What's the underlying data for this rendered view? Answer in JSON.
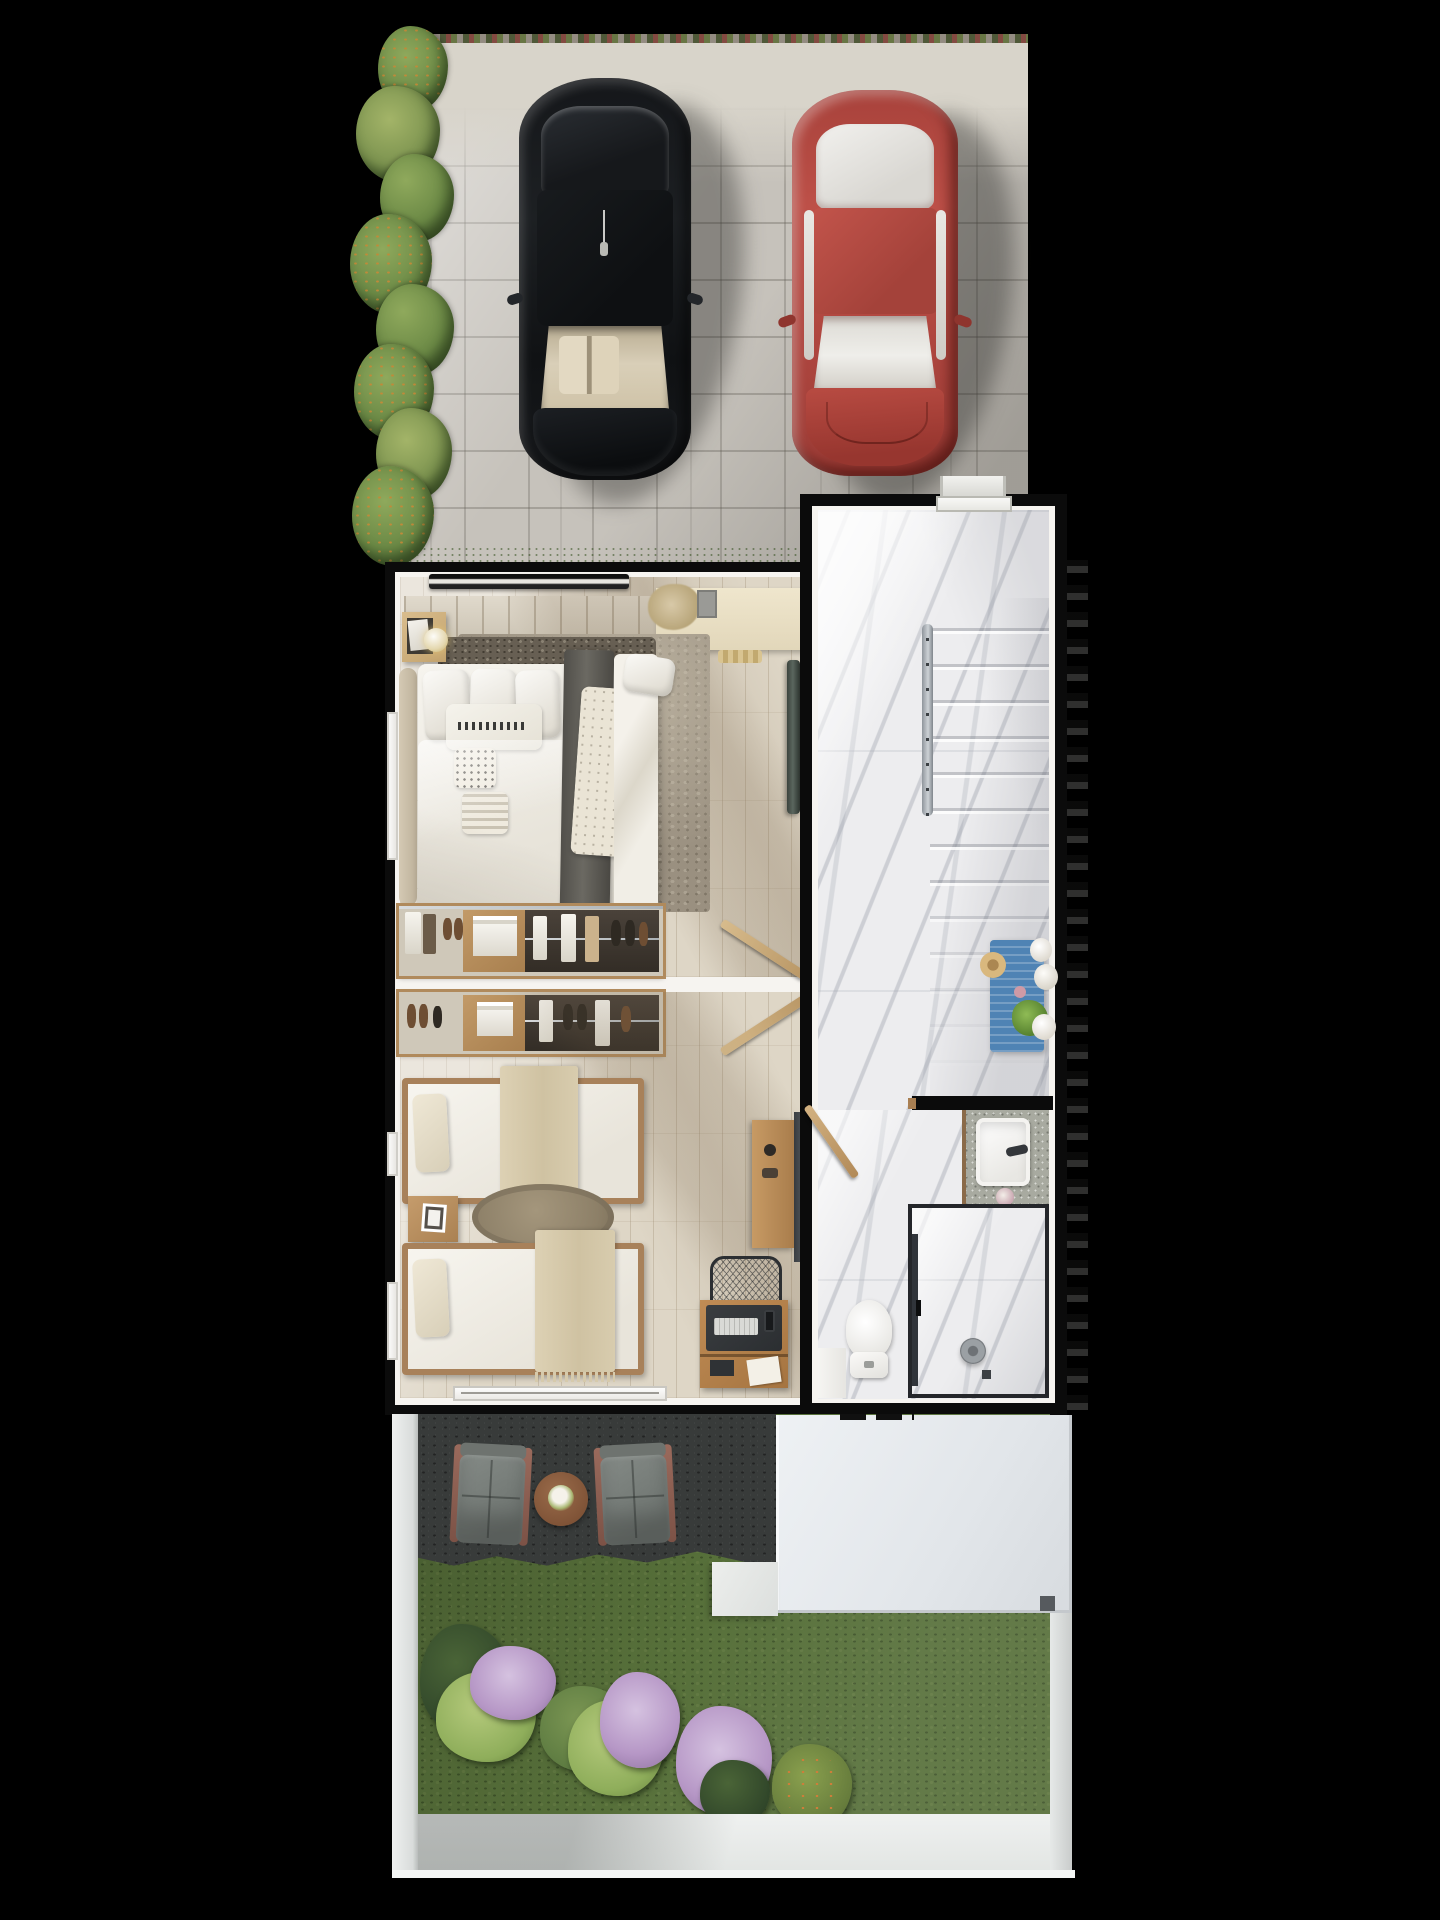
{
  "scene": {
    "title": "3D top-down floor plan rendering",
    "background_color": "#000000",
    "labels": {
      "driveway": "Paved driveway",
      "hedge": "Green hedge",
      "master_bedroom": "Master bedroom",
      "second_bedroom": "Second bedroom",
      "hallway": "Hallway with staircase",
      "bathroom": "Bathroom",
      "backyard": "Backyard garden"
    }
  },
  "exterior": {
    "driveway": {
      "pavement_color": "#c6c2bb",
      "lawn_edge_color": "#79a43e",
      "vehicles": [
        {
          "name": "black-car",
          "body_color": "#17191c",
          "interior_color": "#d9cfb8"
        },
        {
          "name": "red-car",
          "body_color": "#b84b42",
          "glass_color": "#eceae6"
        }
      ],
      "hedge_colors": [
        "#8fa95c",
        "#6c8a46",
        "#4c6633"
      ]
    },
    "backyard": {
      "patio_color": "#383b3a",
      "lawn_color": "#57703a",
      "terrace_color": "#e8ebee",
      "walkway_color": "#eceeed",
      "furniture": [
        "outdoor armchair",
        "round coffee table with flowers",
        "outdoor armchair"
      ],
      "plants": [
        "dark green shrub",
        "lime green shrub",
        "purple flowering shrub",
        "purple flowering shrub",
        "orange-tinged shrub"
      ]
    }
  },
  "floorplan": {
    "wall_color": "#0b0b0b",
    "rooms": [
      {
        "name": "Master bedroom",
        "floor": "light wood planks",
        "furniture": [
          "double bed with gray throw",
          "upholstered headboard",
          "wall-mounted nightstand with lamp",
          "area rug",
          "ceiling vent",
          "wall shelf with pampas grass",
          "wall-mounted TV",
          "open wardrobe with clothes and shoes",
          "open door"
        ]
      },
      {
        "name": "Second bedroom",
        "floor": "light wood planks",
        "furniture": [
          "twin bed",
          "twin bed",
          "nightstand with photo frame",
          "oval rug",
          "floating wall desk",
          "wire chair",
          "desk with keyboard and phone",
          "open wardrobe with clothes and shoes",
          "sliding window",
          "open door"
        ]
      },
      {
        "name": "Hallway with staircase",
        "floor": "white marble",
        "furniture": [
          "entry door with step",
          "stair treads",
          "handrail",
          "blue console bench with plants, hat and vases"
        ]
      },
      {
        "name": "Bathroom",
        "floor": "white marble",
        "furniture": [
          "terrazzo vanity with white sink",
          "walk-in glass shower with drain",
          "toilet",
          "open door"
        ]
      }
    ]
  }
}
